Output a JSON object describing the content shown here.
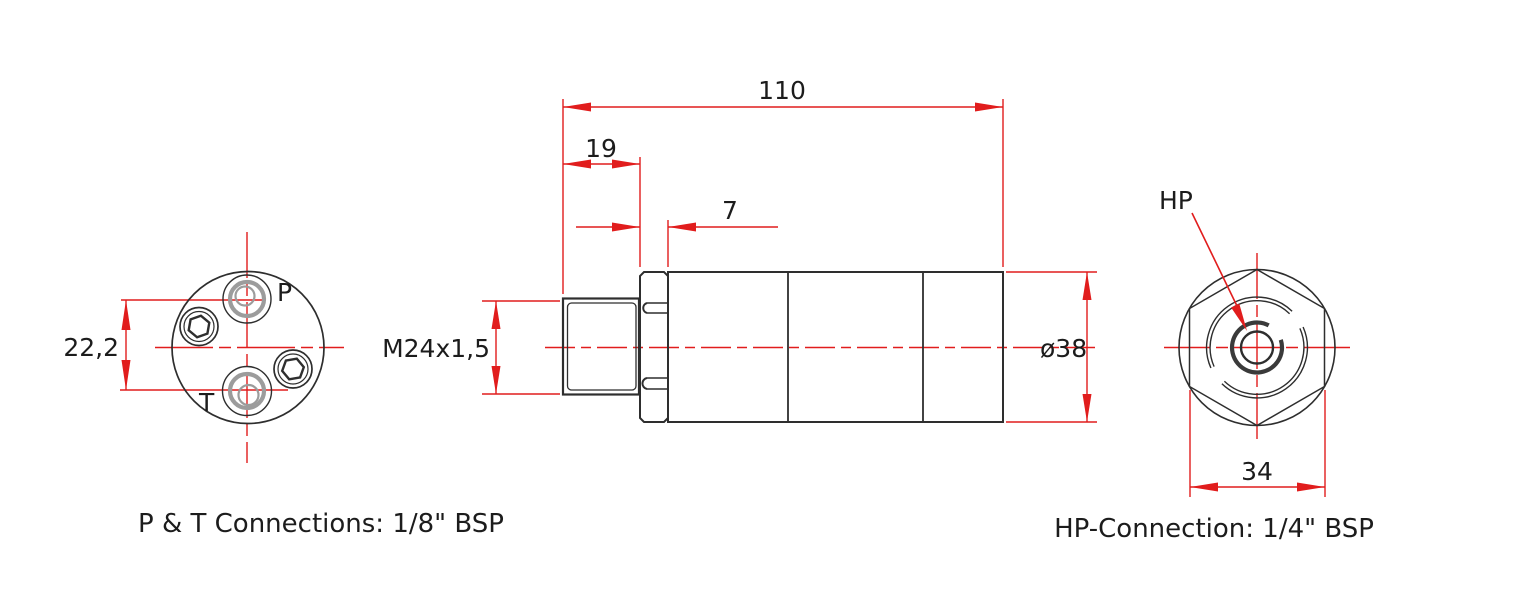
{
  "drawing": {
    "type": "technical-drawing",
    "part": "hydraulic swivel coupling, three orthographic views",
    "captions": {
      "pt": "P & T Connections: 1/8\" BSP",
      "hp": "HP-Connection: 1/4\" BSP"
    },
    "dimensions": {
      "total_length": "110",
      "thread_length": "19",
      "hex_length": "7",
      "thread_spec": "M24x1,5",
      "body_diameter": "ø38",
      "port_spacing": "22,2",
      "hex_across_flats": "34"
    },
    "port_labels": {
      "p": "P",
      "t": "T",
      "hp": "HP"
    },
    "colors": {
      "dimension_red": "#e11d1d",
      "line_dark": "#2e2e2e",
      "ring_gray": "#9c9c9c",
      "text_dark": "#1c1c1c",
      "background": "#ffffff"
    }
  }
}
